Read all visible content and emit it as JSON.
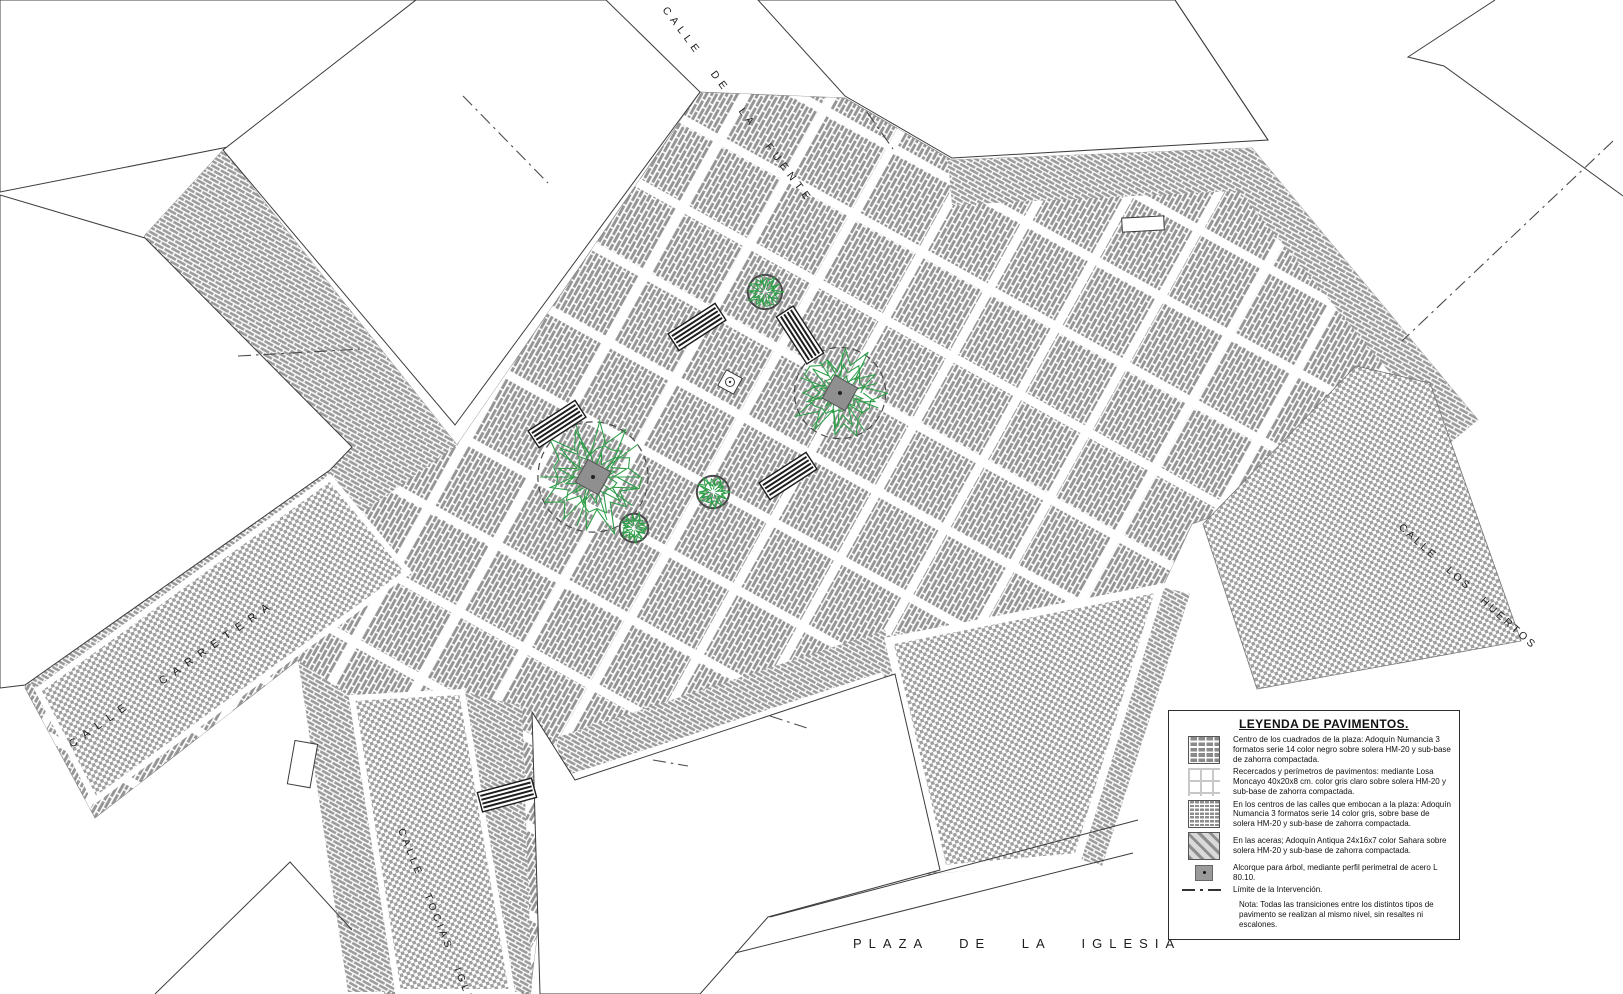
{
  "colors": {
    "paving_gray": "#949494",
    "street_gray": "#9f9f9f",
    "joint_white": "#ffffff",
    "tree_green": "#2f9e49",
    "line_dark": "#3c3c3c"
  },
  "streets": [
    {
      "id": "fuente",
      "label": "CALLE DE LA FUENTE"
    },
    {
      "id": "carretera",
      "label": "CALLE CARRETERA"
    },
    {
      "id": "huertos",
      "label": "CALLE LOS HUERTOS"
    },
    {
      "id": "tocias",
      "label": "CALLE TOCIAS IGLESIA"
    }
  ],
  "plaza_label": "PLAZA DE LA IGLESIA",
  "legend": {
    "title": "LEYENDA DE PAVIMENTOS.",
    "items": [
      {
        "swatch": "plaza-brick",
        "text": "Centro de los cuadrados de la plaza: Adoquín Numancia 3 formatos serie 14 color negro sobre solera HM-20 y sub-base de zahorra compactada."
      },
      {
        "swatch": "losa-grid",
        "text": "Recercados y perímetros de pavimentos:  mediante Losa Moncayo 40x20x8 cm. color gris claro sobre solera HM-20 y sub-base de zahorra compactada."
      },
      {
        "swatch": "street-brick",
        "text": "En los centros de las calles que embocan  a la plaza: Adoquín Numancia 3 formatos serie 14 color gris, sobre base de solera HM-20 y sub-base de zahorra compactada."
      },
      {
        "swatch": "acera-hatch",
        "text": "En las aceras; Adoquín Antiqua 24x16x7 color Sahara sobre solera HM-20 y sub-base de zahorra compactada."
      },
      {
        "swatch": "alcorque",
        "text": "Alcorque para árbol, mediante perfil perimetral de acero L 80.10."
      },
      {
        "swatch": "limit-line",
        "text": "Límite de la Intervención."
      }
    ],
    "note": "Nota: Todas las transiciones entre los distintos tipos de pavimento se realizan al mismo nivel, sin resaltes ni escalones."
  },
  "map": {
    "trees": [
      {
        "cx": 593,
        "cy": 477,
        "r": 58,
        "big": true
      },
      {
        "cx": 840,
        "cy": 393,
        "r": 48,
        "big": true
      },
      {
        "cx": 765,
        "cy": 292,
        "r": 18,
        "big": false
      },
      {
        "cx": 713,
        "cy": 492,
        "r": 17,
        "big": false
      },
      {
        "cx": 634,
        "cy": 528,
        "r": 15,
        "big": false
      }
    ],
    "benches": [
      {
        "x": 697,
        "y": 327,
        "rot": -33
      },
      {
        "x": 800,
        "y": 335,
        "rot": 57
      },
      {
        "x": 557,
        "y": 424,
        "rot": -33
      },
      {
        "x": 788,
        "y": 476,
        "rot": -33
      },
      {
        "x": 507,
        "y": 795,
        "rot": -15
      }
    ],
    "utility_marker": {
      "x": 730,
      "y": 382
    }
  }
}
